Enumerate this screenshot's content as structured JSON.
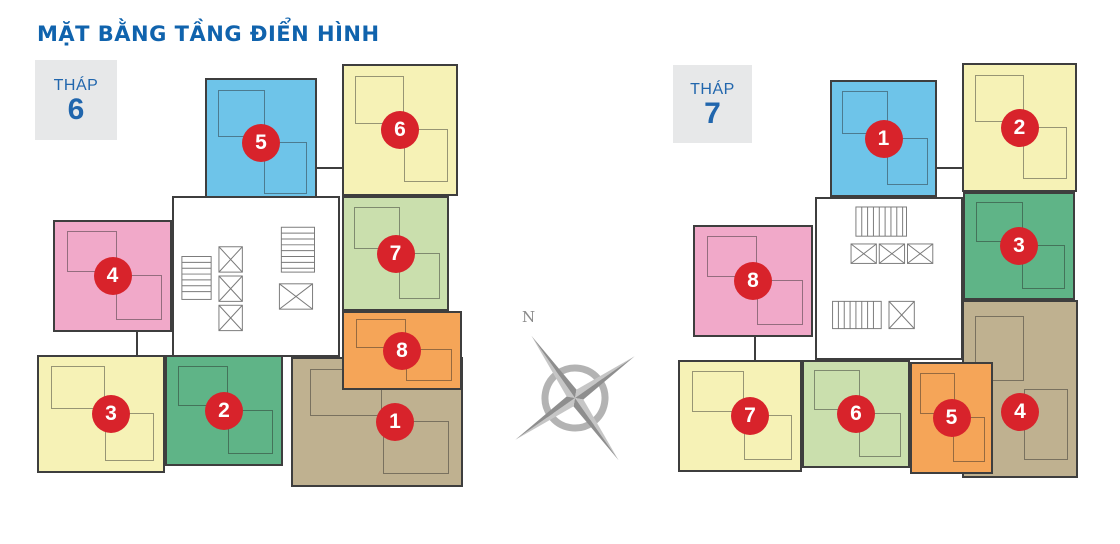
{
  "page": {
    "title": "MẶT BẰNG TẦNG ĐIỂN HÌNH"
  },
  "compass": {
    "north_label": "N"
  },
  "colors": {
    "title_text": "#1063AD",
    "tower_label_text": "#2166AD",
    "tower_label_bg": "#E7E8E9",
    "badge_bg": "#D8232B",
    "badge_text": "#FFFFFF",
    "wall": "#3E3E3E",
    "core_bg": "#FFFFFF",
    "core_line": "#7A7A7A",
    "unit_blue": "#6EC4E9",
    "unit_yellow": "#F6F2B6",
    "unit_light_green": "#CADFAD",
    "unit_green": "#5FB487",
    "unit_orange": "#F5A558",
    "unit_brown": "#BFB190",
    "unit_pink": "#F1A9C9",
    "compass_dark": "#8E8E8E",
    "compass_light": "#C6C6C6"
  },
  "towers": [
    {
      "name": "THÁP",
      "tower_number": "6",
      "units": [
        {
          "number": "1",
          "color": "brown"
        },
        {
          "number": "2",
          "color": "green"
        },
        {
          "number": "3",
          "color": "yellow"
        },
        {
          "number": "4",
          "color": "pink"
        },
        {
          "number": "5",
          "color": "blue"
        },
        {
          "number": "6",
          "color": "yellow"
        },
        {
          "number": "7",
          "color": "light_green"
        },
        {
          "number": "8",
          "color": "orange"
        }
      ]
    },
    {
      "name": "THÁP",
      "tower_number": "7",
      "units": [
        {
          "number": "1",
          "color": "blue"
        },
        {
          "number": "2",
          "color": "yellow"
        },
        {
          "number": "3",
          "color": "green"
        },
        {
          "number": "4",
          "color": "brown"
        },
        {
          "number": "5",
          "color": "orange"
        },
        {
          "number": "6",
          "color": "light_green"
        },
        {
          "number": "7",
          "color": "yellow"
        },
        {
          "number": "8",
          "color": "pink"
        }
      ]
    }
  ]
}
